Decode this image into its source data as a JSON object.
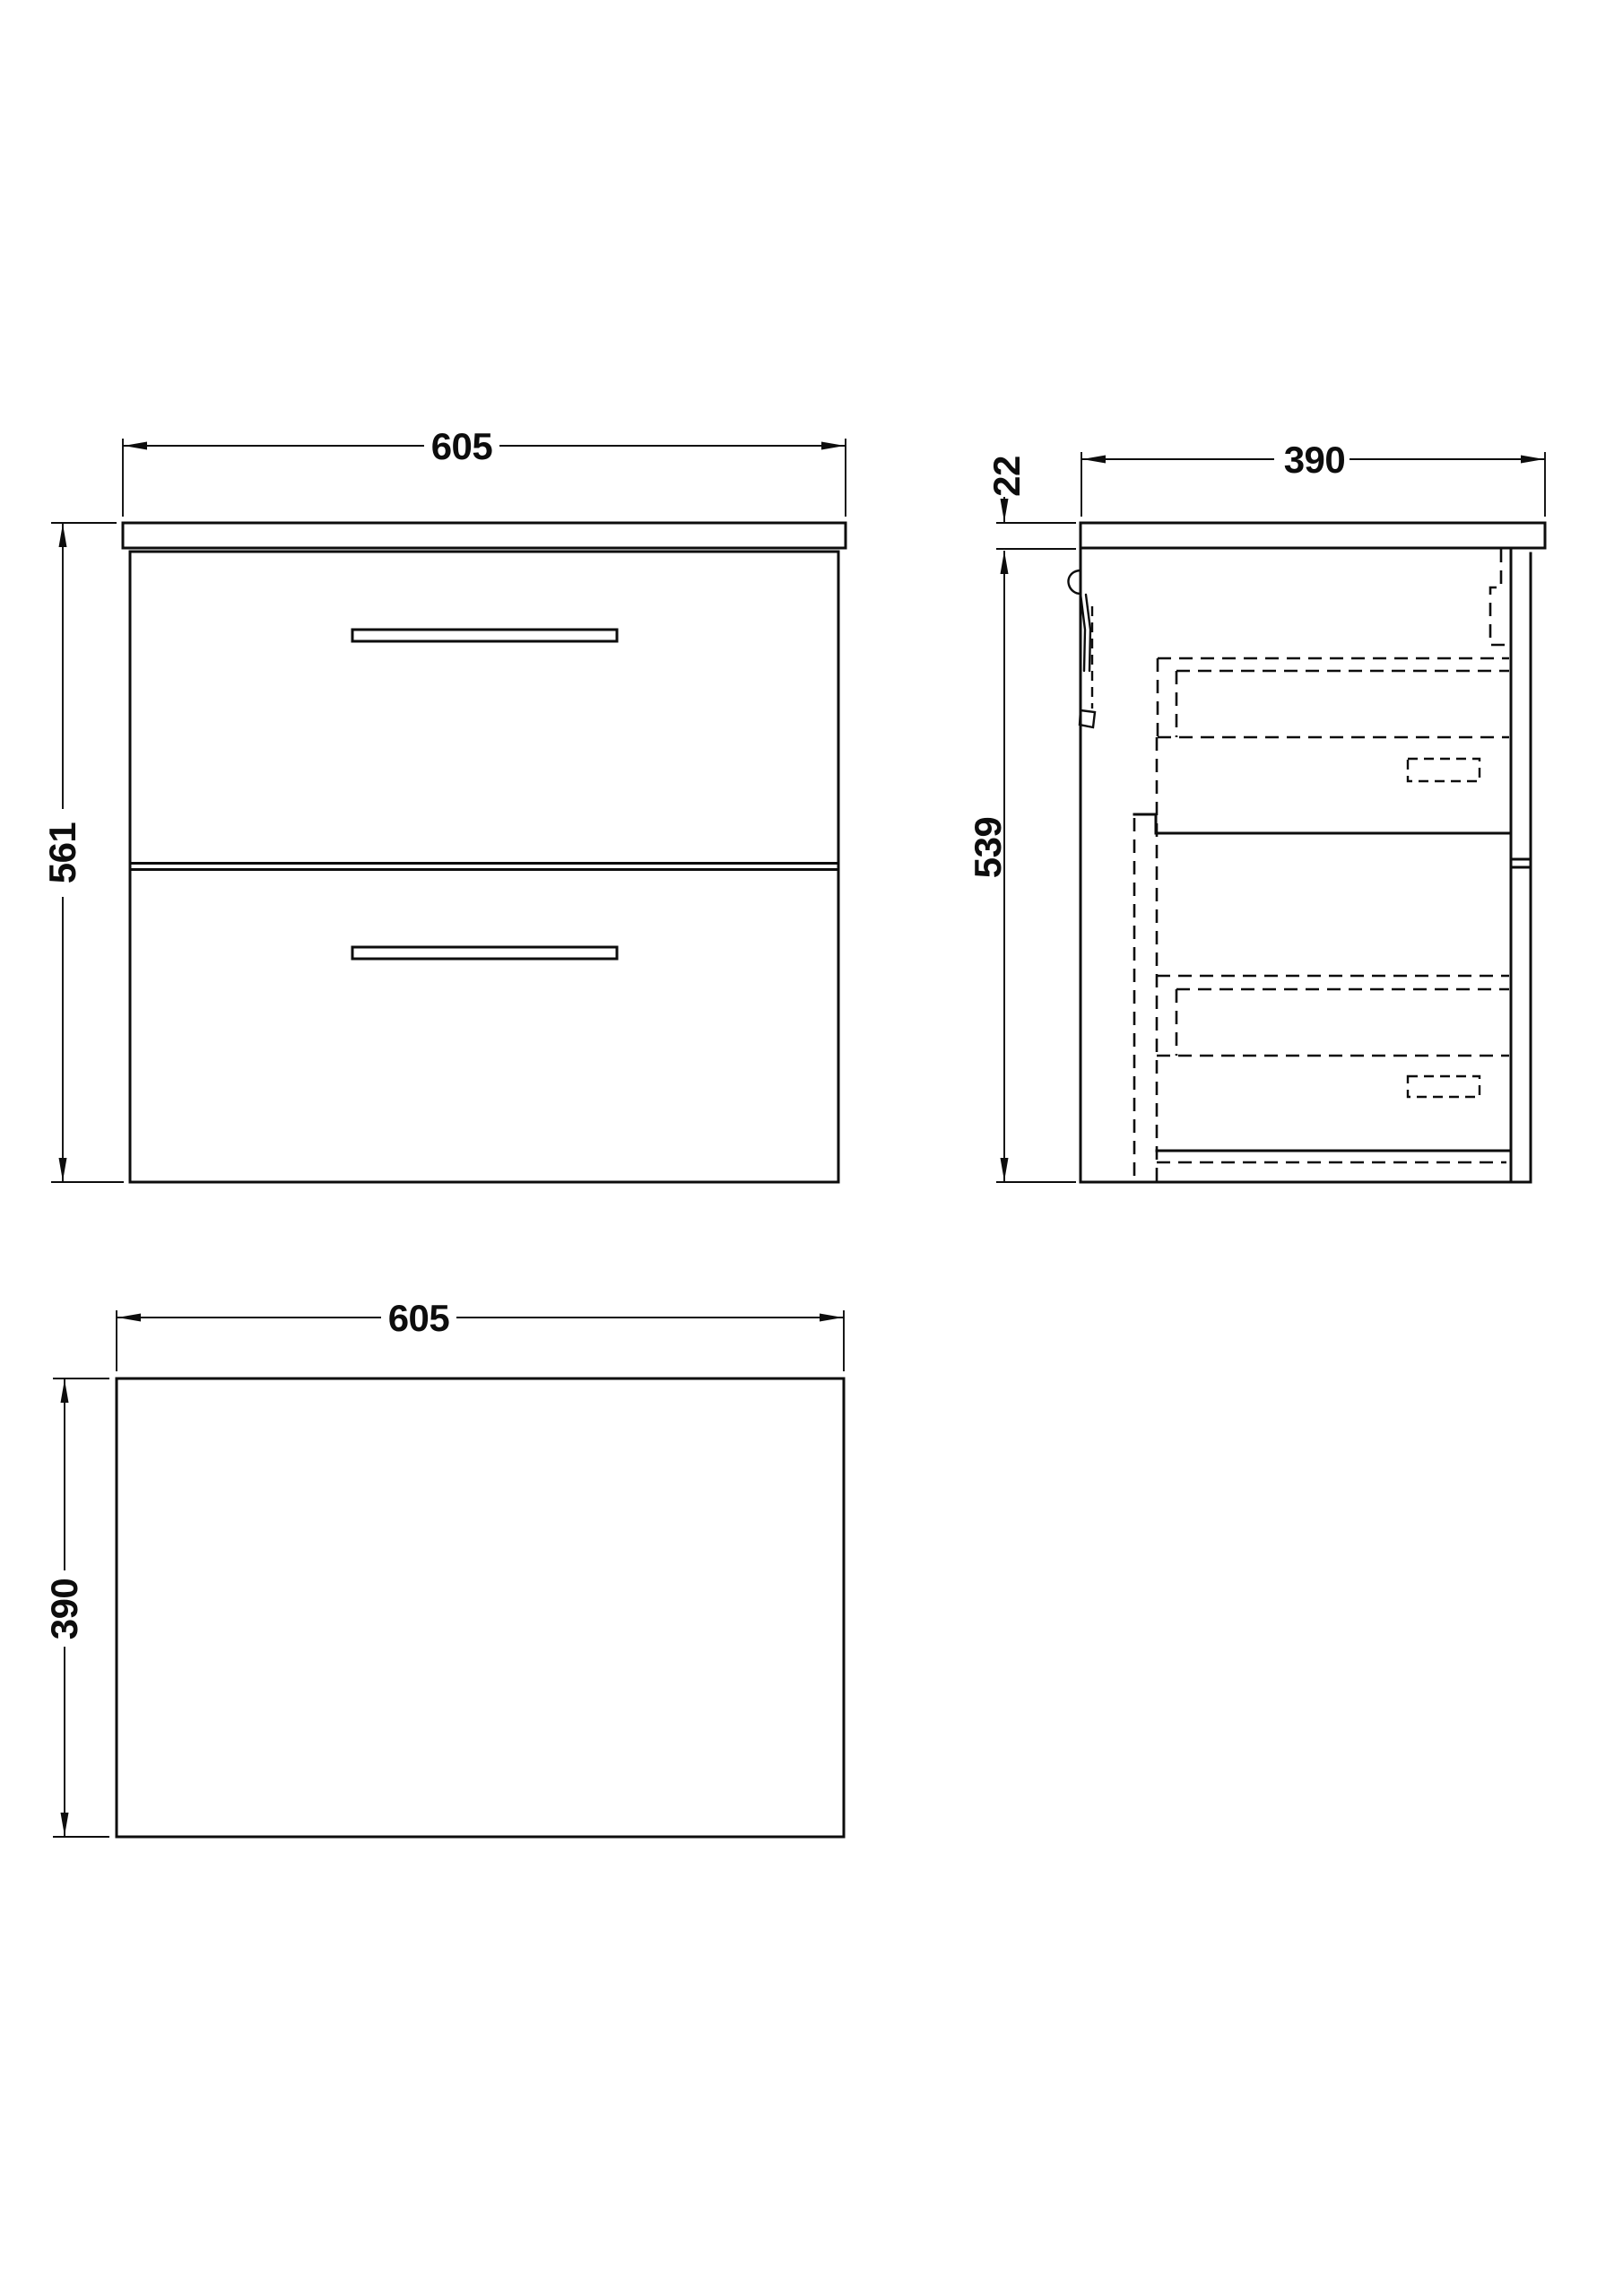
{
  "drawing": {
    "background_color": "#ffffff",
    "line_color": "#0d0d0d",
    "unit_system": "mm",
    "front_view": {
      "width": "605",
      "height": "561"
    },
    "side_view": {
      "depth": "390",
      "worktop_thickness": "22",
      "cabinet_height": "539"
    },
    "plan_view": {
      "width": "605",
      "depth": "390"
    }
  }
}
